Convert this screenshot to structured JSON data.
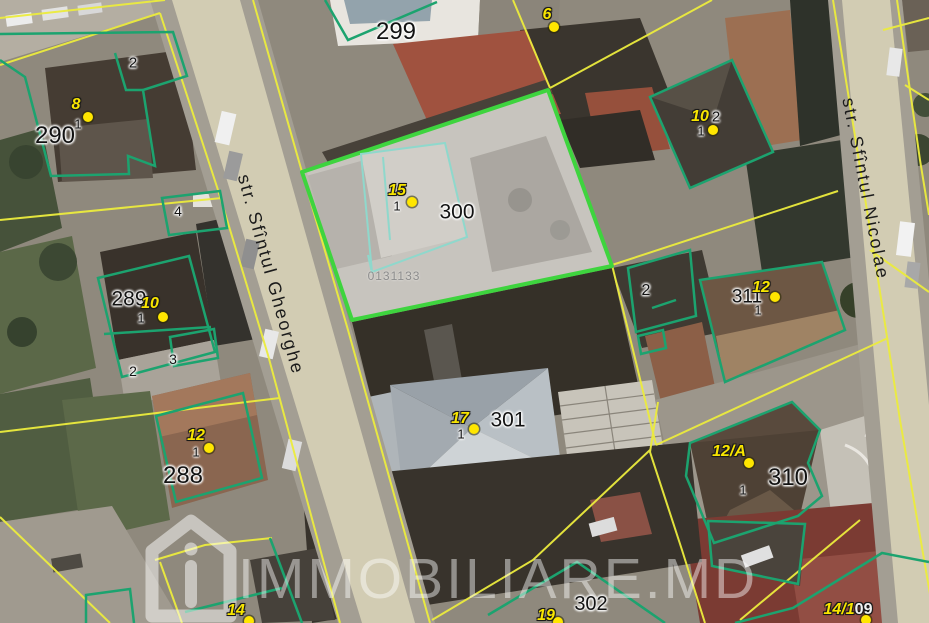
{
  "map": {
    "streets": [
      {
        "name": "str. Sfîntul Gheorghe"
      },
      {
        "name": "str. Sfîntul Nicolae"
      }
    ],
    "watermark": {
      "text": "IMMOBILIARE.MD",
      "logo": "house-icon"
    },
    "selected_parcel": {
      "number": "300",
      "cadastral_code": "0131133"
    },
    "cadastral_code_label": {
      "text": "0131133",
      "x": 394,
      "y": 276,
      "size": 12
    },
    "parcel_labels": [
      {
        "text": "290",
        "x": 55,
        "y": 136,
        "size": 24
      },
      {
        "text": "289",
        "x": 129,
        "y": 299,
        "size": 21
      },
      {
        "text": "288",
        "x": 183,
        "y": 476,
        "size": 24
      },
      {
        "text": "299",
        "x": 396,
        "y": 32,
        "size": 24
      },
      {
        "text": "300",
        "x": 457,
        "y": 212,
        "size": 21
      },
      {
        "text": "301",
        "x": 508,
        "y": 420,
        "size": 21
      },
      {
        "text": "302",
        "x": 591,
        "y": 604,
        "size": 20
      },
      {
        "text": "310",
        "x": 788,
        "y": 478,
        "size": 24
      },
      {
        "text": "311",
        "x": 747,
        "y": 297,
        "size": 19
      },
      {
        "text": "2",
        "x": 133,
        "y": 63,
        "size": 15
      },
      {
        "text": "4",
        "x": 178,
        "y": 211,
        "size": 14
      },
      {
        "text": "2",
        "x": 133,
        "y": 371,
        "size": 14
      },
      {
        "text": "3",
        "x": 173,
        "y": 359,
        "size": 14
      },
      {
        "text": "2",
        "x": 646,
        "y": 291,
        "size": 16
      },
      {
        "text": "2",
        "x": 716,
        "y": 117,
        "size": 15
      }
    ],
    "house_markers": [
      {
        "label": "8",
        "x": 76,
        "y": 105,
        "dot_x": 88,
        "dot_y": 117,
        "unit": "1",
        "unit_x": 78,
        "unit_y": 124
      },
      {
        "label": "10",
        "x": 150,
        "y": 304,
        "dot_x": 163,
        "dot_y": 317,
        "unit": "1",
        "unit_x": 141,
        "unit_y": 318
      },
      {
        "label": "12",
        "x": 196,
        "y": 436,
        "dot_x": 209,
        "dot_y": 448,
        "unit": "1",
        "unit_x": 196,
        "unit_y": 452
      },
      {
        "label": "14",
        "x": 236,
        "y": 611,
        "dot_x": 249,
        "dot_y": 621
      },
      {
        "label": "15",
        "x": 397,
        "y": 191,
        "dot_x": 412,
        "dot_y": 202,
        "unit": "1",
        "unit_x": 397,
        "unit_y": 206
      },
      {
        "label": "17",
        "x": 460,
        "y": 419,
        "dot_x": 474,
        "dot_y": 429,
        "unit": "1",
        "unit_x": 461,
        "unit_y": 434
      },
      {
        "label": "6",
        "x": 547,
        "y": 15,
        "dot_x": 554,
        "dot_y": 27
      },
      {
        "label": "10",
        "x": 700,
        "y": 117,
        "dot_x": 713,
        "dot_y": 130,
        "unit": "1",
        "unit_x": 701,
        "unit_y": 131
      },
      {
        "label": "12",
        "x": 761,
        "y": 288,
        "dot_x": 775,
        "dot_y": 297,
        "unit": "1",
        "unit_x": 758,
        "unit_y": 310
      },
      {
        "label": "12/A",
        "x": 729,
        "y": 452,
        "dot_x": 749,
        "dot_y": 463,
        "unit": "1",
        "unit_x": 743,
        "unit_y": 490
      },
      {
        "label": "19",
        "x": 546,
        "y": 616,
        "dot_x": 558,
        "dot_y": 622
      },
      {
        "label": "14/1",
        "extra": "09",
        "x": 848,
        "y": 610,
        "dot_x": 866,
        "dot_y": 620
      }
    ],
    "colors": {
      "boundary_yellow": "#ecec3d",
      "outline_green": "#1ca36f",
      "selected_parcel_green": "#3ed43e",
      "building_inner_teal": "#8fd8cc",
      "marker_yellow": "#ffe600",
      "road_beige": "#d2ccb3",
      "watermark_white": "rgba(255,255,255,0.45)"
    }
  }
}
